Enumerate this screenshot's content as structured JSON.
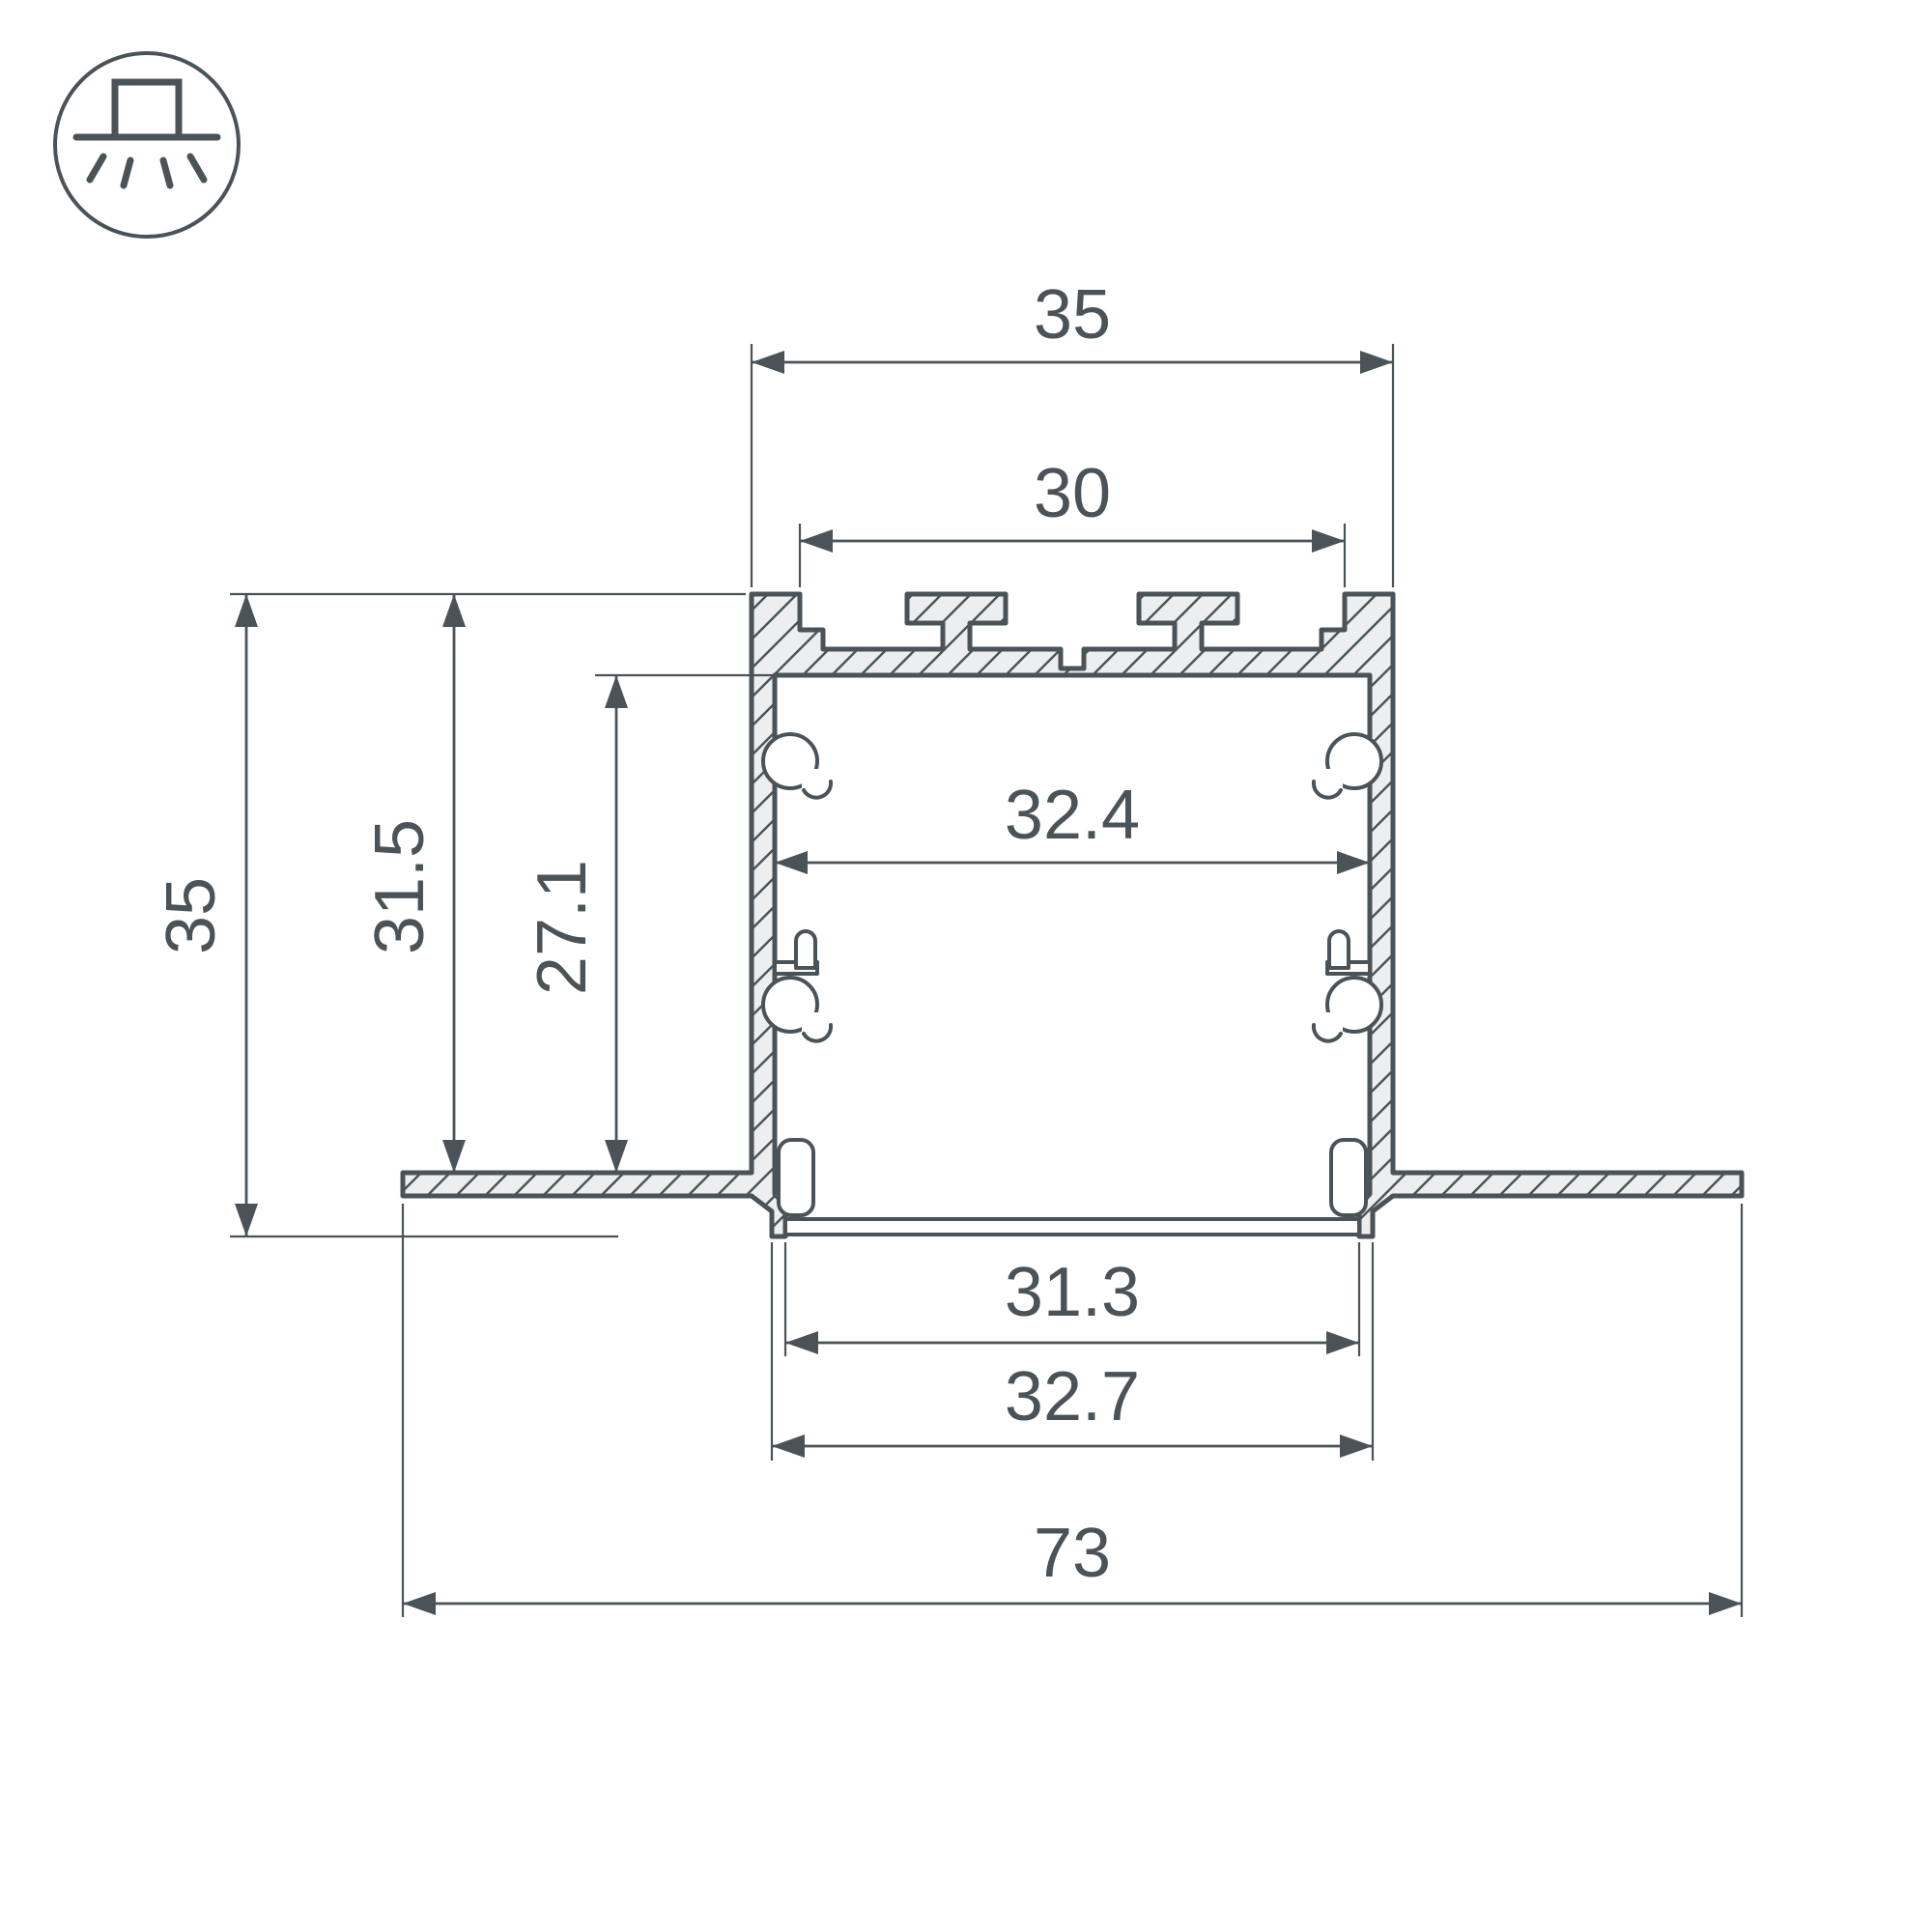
{
  "icon": {
    "name": "recessed-ceiling-light",
    "description": "square luminaire recessed in ceiling line with light rays below"
  },
  "dims": {
    "top_width": "35",
    "top_opening": "30",
    "cavity_width": "32.4",
    "side_height": "35",
    "recess_depth": "31.5",
    "cavity_height": "27.1",
    "bottom_opening": "31.3",
    "bottom_width": "32.7",
    "overall_width": "73"
  },
  "colors": {
    "line": "#4a5358",
    "fill": "#eceeef",
    "background": "#ffffff"
  }
}
